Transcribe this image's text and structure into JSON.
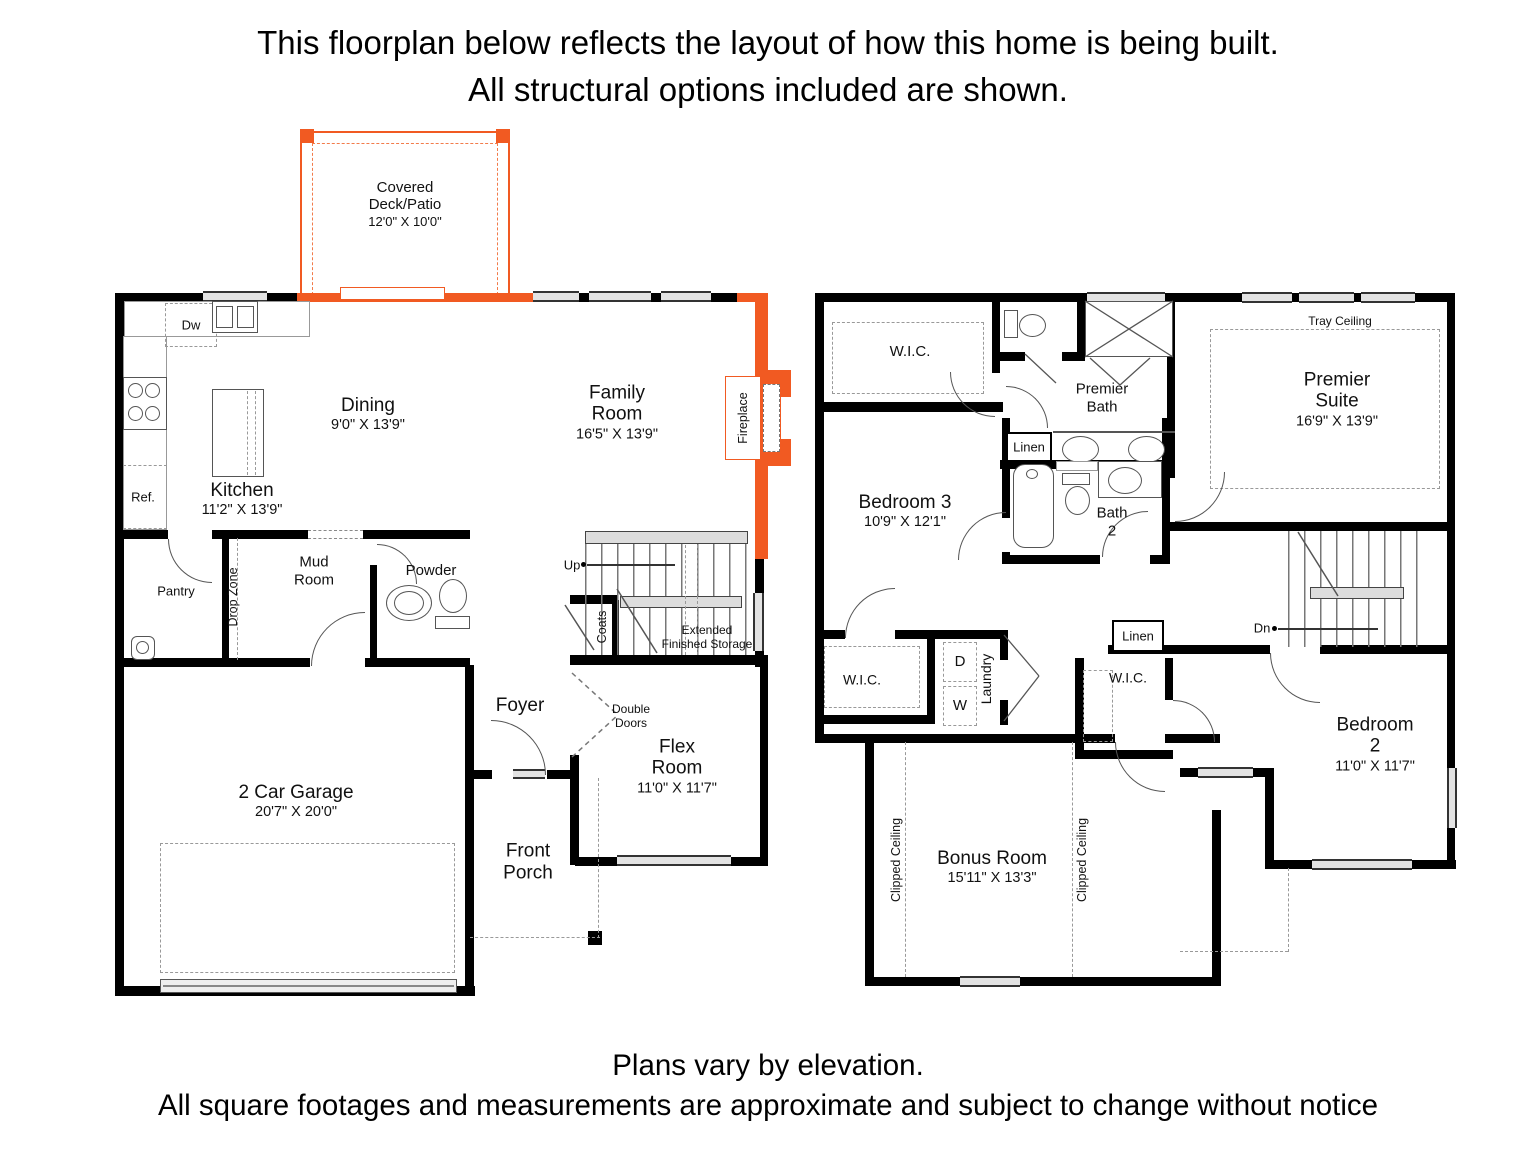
{
  "header": {
    "line1": "This floorplan below reflects the layout of how this home is being built.",
    "line2": "All structural options included are shown."
  },
  "footer": {
    "line1": "Plans vary by elevation.",
    "line2": "All square footages and measurements are approximate and subject to change without notice"
  },
  "colors": {
    "accent_orange": "#f15a22",
    "wall_black": "#000000",
    "window_gray": "#e3e3e3"
  },
  "floor1": {
    "covered_deck": {
      "name": "Covered Deck/Patio",
      "dims": "12'0\" X 10'0\""
    },
    "dining": {
      "name": "Dining",
      "dims": "9'0\" X 13'9\""
    },
    "kitchen": {
      "name": "Kitchen",
      "dims": "11'2\" X 13'9\""
    },
    "family_room": {
      "name": "Family Room",
      "dims": "16'5\" X 13'9\""
    },
    "fireplace": "Fireplace",
    "dw": "Dw",
    "ref": "Ref.",
    "pantry": "Pantry",
    "drop_zone": "Drop Zone",
    "mud_room": "Mud Room",
    "powder": "Powder",
    "up": "Up",
    "coats": "Coats",
    "extended_storage": "Extended\nFinished Storage",
    "foyer": "Foyer",
    "double_doors": "Double Doors",
    "flex_room": {
      "name": "Flex Room",
      "dims": "11'0\" X 11'7\""
    },
    "front_porch": "Front Porch",
    "garage": {
      "name": "2 Car Garage",
      "dims": "20'7\" X 20'0\""
    }
  },
  "floor2": {
    "wic_premier": "W.I.C.",
    "premier_bath": "Premier Bath",
    "linen_premier": "Linen",
    "tray_ceiling": "Tray Ceiling",
    "premier_suite": {
      "name": "Premier Suite",
      "dims": "16'9\" X 13'9\""
    },
    "bedroom3": {
      "name": "Bedroom 3",
      "dims": "10'9\" X 12'1\""
    },
    "bath2": "Bath\n2",
    "dn": "Dn",
    "wic_bed3": "W.I.C.",
    "laundry": "Laundry",
    "dryer": "D",
    "washer": "W",
    "linen_hall": "Linen",
    "wic_bed2": "W.I.C.",
    "bonus_room": {
      "name": "Bonus Room",
      "dims": "15'11\" X 13'3\""
    },
    "clipped_ceiling": "Clipped Ceiling",
    "bedroom2": {
      "name": "Bedroom 2",
      "dims": "11'0\" X 11'7\""
    }
  }
}
